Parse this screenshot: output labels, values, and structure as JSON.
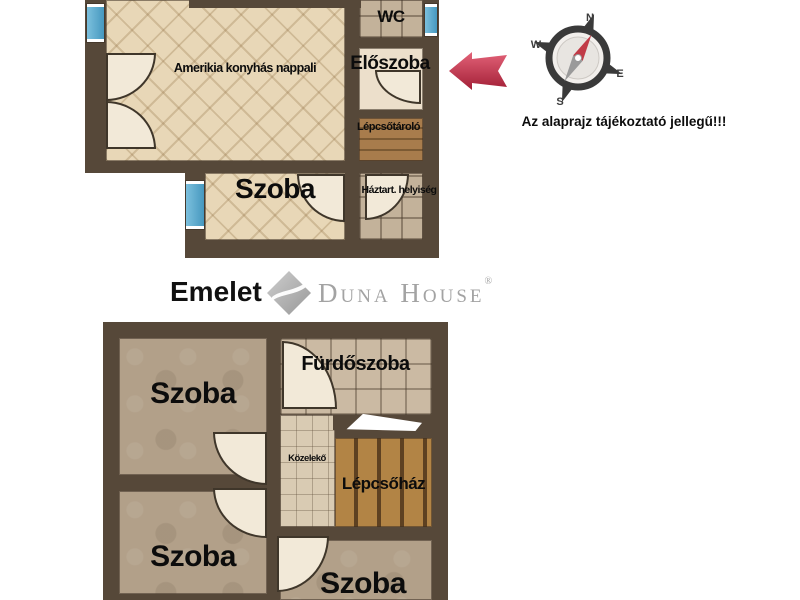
{
  "disclaimer": {
    "text": "Az alaprajz tájékoztató jellegű!!!"
  },
  "compass": {
    "n": "N",
    "e": "E",
    "s": "S",
    "w": "W"
  },
  "logo": {
    "text": "Duna House",
    "reg": "®"
  },
  "upper_plan": {
    "rooms": {
      "living": {
        "label": "Amerikia konyhás nappali"
      },
      "wc": {
        "label": "WC"
      },
      "hall": {
        "label": "Előszoba"
      },
      "stair_storage": {
        "label": "Lépcsőtároló"
      },
      "room": {
        "label": "Szoba"
      },
      "utility": {
        "label": "Háztart. helyiség"
      }
    }
  },
  "lower_plan": {
    "title": "Emelet",
    "rooms": {
      "room_tl": {
        "label": "Szoba"
      },
      "bathroom": {
        "label": "Fürdőszoba"
      },
      "corridor": {
        "label": "Közelekő"
      },
      "staircase": {
        "label": "Lépcsőház"
      },
      "room_bl": {
        "label": "Szoba"
      },
      "room_bc": {
        "label": "Szoba"
      }
    }
  },
  "colors": {
    "wall": "#564839",
    "window_blue": "#55a7cb",
    "arrow_red": "#c62f4b",
    "needle_red": "#c13b47",
    "logo_gray": "#a3a3a3",
    "parquet": "#e8d7b7",
    "door_fill": "#f2e9d8"
  }
}
